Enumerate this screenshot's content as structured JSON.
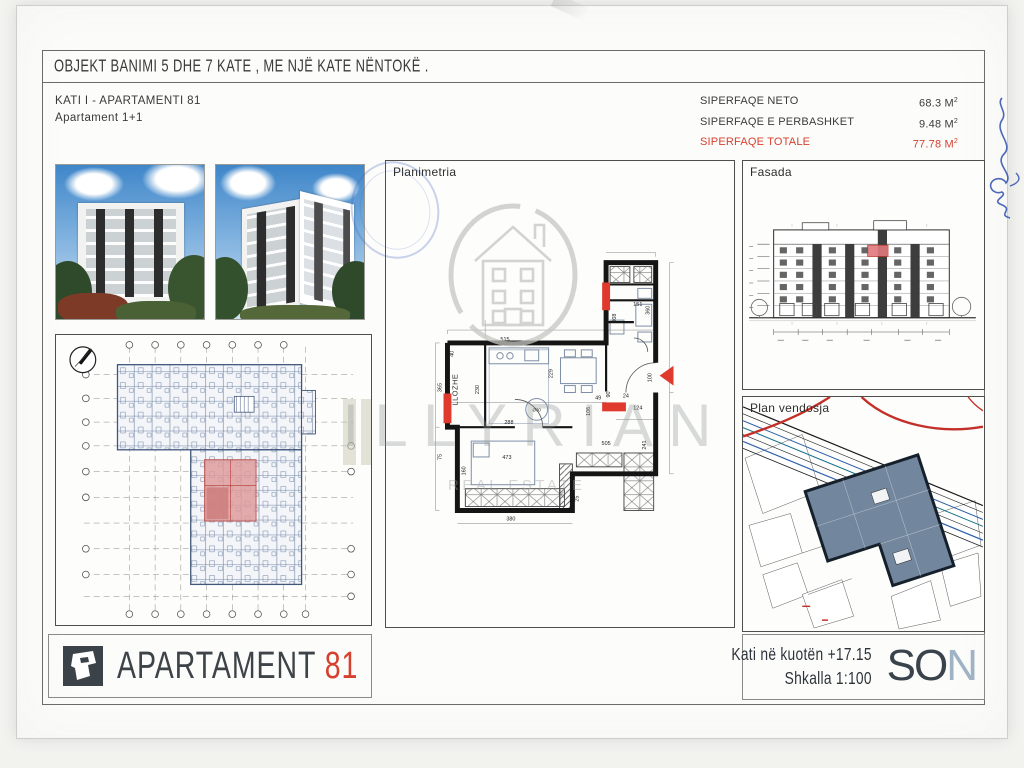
{
  "header": {
    "title": "OBJEKT BANIMI 5 DHE 7 KATE , ME NJË KATE NËNTOKË .",
    "subtitle_line1": "KATI I - APARTAMENTI  81",
    "subtitle_line2": "Apartament 1+1",
    "areas": [
      {
        "label": "SIPERFAQE NETO",
        "value": "68.3",
        "unit": "M",
        "sup": "2"
      },
      {
        "label": "SIPERFAQE E PERBASHKET",
        "value": "9.48",
        "unit": "M",
        "sup": "2"
      },
      {
        "label": "SIPERFAQE TOTALE",
        "value": "77.78",
        "unit": "M",
        "sup": "2"
      }
    ]
  },
  "panels": {
    "planimetria": {
      "label": "Planimetria",
      "room_label": "LLOZHE",
      "stove_label": "Ø30",
      "dimensions": [
        "515",
        "229",
        "230",
        "288",
        "473",
        "160",
        "365",
        "151",
        "308",
        "360",
        "100",
        "90",
        "124",
        "106",
        "75",
        "40",
        "25",
        "505",
        "241",
        "49",
        "24",
        "380"
      ]
    },
    "fasada": {
      "label": "Fasada"
    },
    "site": {
      "label": "Plan vendosja"
    }
  },
  "watermark": {
    "brand": "ILLYRIAN",
    "tagline": "REAL ESTATE"
  },
  "footer": {
    "project_name": "APARTAMENT",
    "project_number": "81",
    "level_note": "Kati në kuotën +17.15",
    "scale_note": "Shkalla 1:100",
    "logo_part_dark": "SO",
    "logo_part_light": "N"
  },
  "colors": {
    "accent_red": "#d6402e",
    "plan_blue": "#44597a",
    "logo_dark": "#3a434c",
    "logo_light": "#9fb3c4"
  }
}
